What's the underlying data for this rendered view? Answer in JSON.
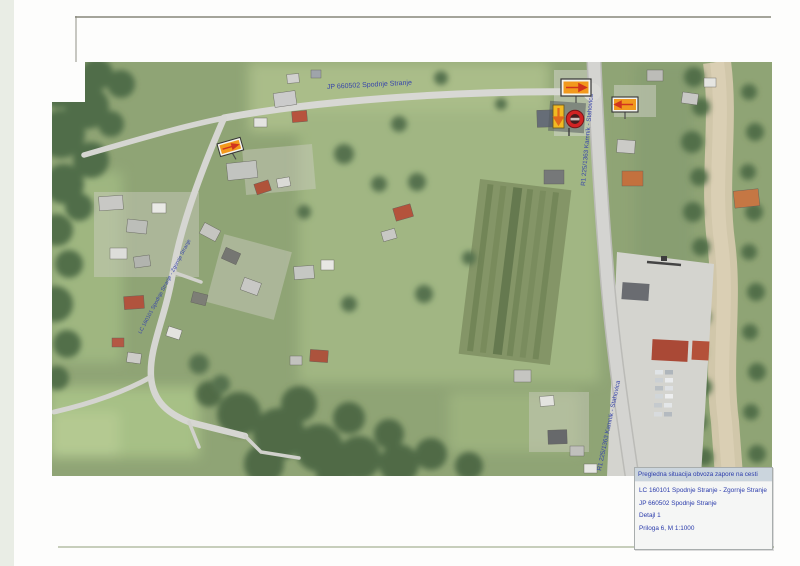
{
  "legend": {
    "title": "Pregledna situacija obvoza zapore na cesti",
    "items": [
      "LC 160101 Spodnje Stranje - Zgornje Stranje",
      "JP 660502 Spodnje Stranje",
      "Detajl 1",
      "Priloga 6, M 1:1000"
    ]
  },
  "roads": {
    "jp_label": "JP 660502 Spodnje Stranje",
    "r1_upper_label": "R1 225/1363 Kamnik - Stahovica",
    "r1_lower_label": "R1 225/1363 Kamnik - Stahovica",
    "lc_label": "LC 160101 Spodnje Stranje - Zgornje Stranje"
  },
  "signs": {
    "west": "detour-arrow-sign",
    "north": "detour-arrow-sign",
    "east": "detour-arrow-sign",
    "closure": "road-closed-sign",
    "closure_arrow": "detour-direction-down-sign"
  },
  "colors": {
    "label_blue": "#2c3aa6",
    "sign_orange": "#f29411",
    "sign_red": "#cf2a12",
    "sign_yellow": "#f2b618",
    "legend_header_bg": "#cbd5dd",
    "map_green": "#8aa06e"
  }
}
